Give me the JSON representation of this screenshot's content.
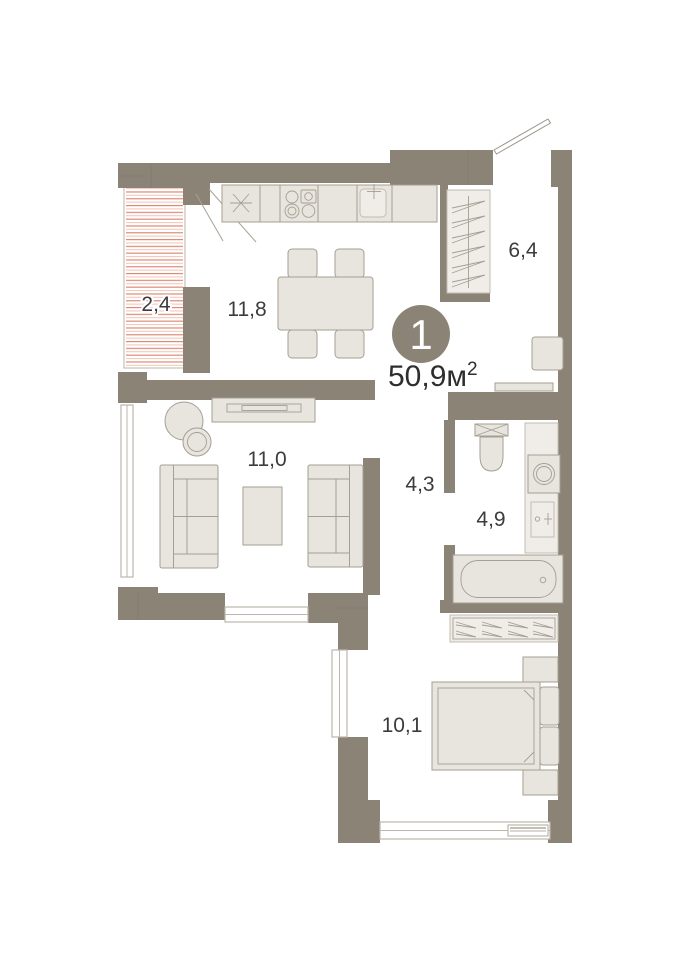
{
  "unit": {
    "rooms_count": "1",
    "area_value": "50,9м",
    "area_superscript": "2"
  },
  "rooms": [
    {
      "id": "balcony",
      "label": "2,4"
    },
    {
      "id": "kitchen-dining",
      "label": "11,8"
    },
    {
      "id": "hallway",
      "label": "6,4"
    },
    {
      "id": "living-room",
      "label": "11,0"
    },
    {
      "id": "corridor",
      "label": "4,3"
    },
    {
      "id": "bathroom",
      "label": "4,9"
    },
    {
      "id": "bedroom",
      "label": "10,1"
    }
  ],
  "colors": {
    "wall": "#8c8377",
    "furniture_fill": "#e8e5df",
    "furniture_stroke": "#a59e92",
    "balcony_hatch_strong": "#dd8570",
    "balcony_hatch_light": "#f2c6ba",
    "badge_fill": "#8c8377",
    "badge_text": "#ffffff",
    "label_text": "#3c3c3c"
  }
}
